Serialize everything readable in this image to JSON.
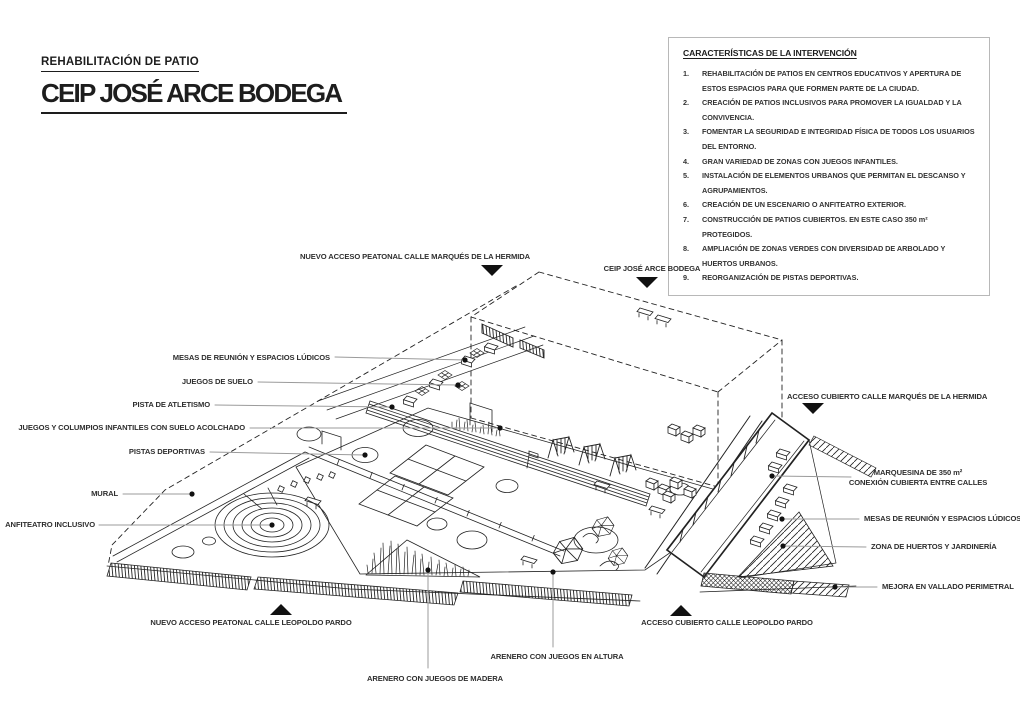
{
  "page": {
    "background": "#ffffff",
    "ink_color": "#222222",
    "leader_color": "#9b9b9b",
    "marker_color": "#111111",
    "panel_border_color": "#b8b8b8"
  },
  "header": {
    "subtitle": "REHABILITACIÓN DE PATIO",
    "title": "CEIP JOSÉ ARCE BODEGA"
  },
  "panel": {
    "title": "CARACTERÍSTICAS DE LA INTERVENCIÓN",
    "items": [
      "REHABILITACIÓN DE PATIOS EN CENTROS EDUCATIVOS Y APERTURA DE ESTOS ESPACIOS PARA QUE FORMEN PARTE DE LA CIUDAD.",
      "CREACIÓN DE PATIOS INCLUSIVOS PARA PROMOVER LA IGUALDAD Y LA CONVIVENCIA.",
      "FOMENTAR LA SEGURIDAD E INTEGRIDAD FÍSICA DE TODOS LOS USUARIOS DEL ENTORNO.",
      "GRAN VARIEDAD DE ZONAS CON JUEGOS INFANTILES.",
      "INSTALACIÓN DE ELEMENTOS URBANOS QUE PERMITAN EL DESCANSO Y AGRUPAMIENTOS.",
      "CREACIÓN DE UN ESCENARIO O ANFITEATRO EXTERIOR.",
      "CONSTRUCCIÓN DE PATIOS CUBIERTOS. EN ESTE CASO 350 m² PROTEGIDOS.",
      "AMPLIACIÓN DE ZONAS VERDES CON DIVERSIDAD DE ARBOLADO Y HUERTOS URBANOS.",
      "REORGANIZACIÓN DE PISTAS DEPORTIVAS."
    ]
  },
  "callouts": {
    "acceso_peatonal_hermida": "NUEVO ACCESO PEATONAL CALLE MARQUÉS DE LA HERMIDA",
    "ceip": "CEIP JOSÉ ARCE BODEGA",
    "acceso_cubierto_hermida": "ACCESO CUBIERTO CALLE MARQUÉS DE LA HERMIDA",
    "mesas_izq": "MESAS DE REUNIÓN Y ESPACIOS LÚDICOS",
    "juegos_suelo": "JUEGOS DE SUELO",
    "pista_atletismo": "PISTA DE ATLETISMO",
    "columpios": "JUEGOS Y COLUMPIOS INFANTILES CON SUELO ACOLCHADO",
    "pistas_deportivas": "PISTAS DEPORTIVAS",
    "mural": "MURAL",
    "anfiteatro": "ANFITEATRO INCLUSIVO",
    "marquesina_l1": "MARQUESINA DE 350 m²",
    "marquesina_l2": "CONEXIÓN CUBIERTA ENTRE CALLES",
    "mesas_der": "MESAS DE REUNIÓN Y ESPACIOS LÚDICOS",
    "huertos": "ZONA DE HUERTOS Y JARDINERÍA",
    "vallado": "MEJORA EN VALLADO PERIMETRAL",
    "acceso_peatonal_leopoldo": "NUEVO ACCESO PEATONAL CALLE LEOPOLDO PARDO",
    "acceso_cubierto_leopoldo": "ACCESO CUBIERTO CALLE LEOPOLDO PARDO",
    "arenero_altura": "ARENERO CON JUEGOS EN ALTURA",
    "arenero_madera": "ARENERO CON JUEGOS DE MADERA"
  }
}
